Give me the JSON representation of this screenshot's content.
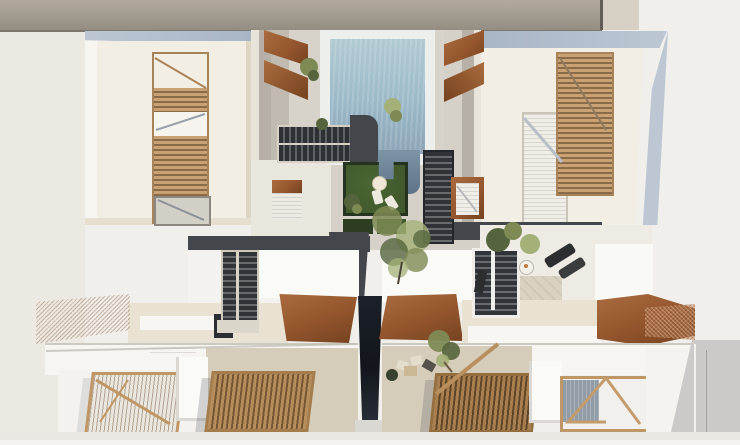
{
  "meta": {
    "type": "architectural-render",
    "view": "aerial-top-down",
    "subject": "residential complex with central pool courtyard, timber pergolas and corten canopies",
    "width_px": 740,
    "height_px": 445
  },
  "colors": {
    "canvas_bg": "#f0efeb",
    "street": "#ebe9e2",
    "top_strip": "#a39b90",
    "top_strip_shadow": "#7e776e",
    "top_strip_side": "#d7d0c4",
    "roof_cream": "#f3eee3",
    "wall_cream": "#e9e2d2",
    "parapet_blue": "#a9b6c6",
    "parapet_blue_light": "#bcc7d3",
    "white_roof": "#f6f5f1",
    "white_bright": "#fafaf7",
    "wood_frame": "#bf9766",
    "wood_slat": "#c9a173",
    "wood_slat_dark": "#745633",
    "corten": "#95562e",
    "corten_light": "#aa6c3f",
    "corten_dark": "#74421f",
    "anthracite": "#43464b",
    "anthracite_dark": "#2d3135",
    "stair_stringer": "#d6d1c3",
    "pool_shallow": "#b0cad2",
    "pool_mid": "#9bb9c8",
    "pool_deep": "#5f7488",
    "lawn": "#41592c",
    "lawn_dark": "#2c3d22",
    "leaf": "#7e8a54",
    "leaf_light": "#a3b077",
    "leaf_dark": "#55643c",
    "alley_dark": "#12161c",
    "terrace_beige": "#d5ccba",
    "gray_strip": "#cbcac8",
    "deck_blue_gray": "#929ca7"
  },
  "scene": {
    "top_strip": {
      "label": "neighboring roof strip along top edge"
    },
    "left_building": {
      "label": "upper-left apartment block",
      "features": [
        "blue-gray parapet edge",
        "cream flat roof",
        "timber louver pergola",
        "white balcony",
        "roof deck"
      ]
    },
    "right_building": {
      "label": "upper-right apartment block",
      "features": [
        "blue-gray parapet edge",
        "cream flat roof",
        "timber louver pergola",
        "striped light deck"
      ]
    },
    "pool_courtyard": {
      "label": "central courtyard between blocks",
      "pool": {
        "label": "swimming pool",
        "water": "light blue fading to deep blue-gray"
      },
      "corten_accents": {
        "label": "rust-steel chevron canopies flanking the pool"
      },
      "lawn": {
        "label": "sunken lawn garden with white loungers and parasol"
      },
      "stairs": [
        "double switchback stair left of lawn",
        "dark tread stair block right of pool",
        "corten framed stair"
      ],
      "walkways": {
        "label": "anthracite walkway band and central path"
      },
      "tree": {
        "label": "olive tree at center of courtyard"
      }
    },
    "right_terrace": {
      "label": "planted terrace below right block",
      "items": [
        "potted plants",
        "two dark sun loungers",
        "round side table",
        "dark bench"
      ]
    },
    "lower_left_unit": {
      "label": "lower-left townhouse",
      "features": [
        "corten entrance canopies",
        "cream wall band with dark glazing slit",
        "double stair down",
        "light timber pergola on white terrace",
        "dense timber pergola on beige terrace"
      ]
    },
    "lower_right_unit": {
      "label": "lower-right townhouse",
      "features": [
        "corten entrance canopies",
        "outdoor dining furniture",
        "small tree",
        "dense timber pergola",
        "timber screen over blue-gray deck",
        "gray side strip"
      ]
    },
    "alley": {
      "label": "dark passage between the two lower units"
    }
  }
}
